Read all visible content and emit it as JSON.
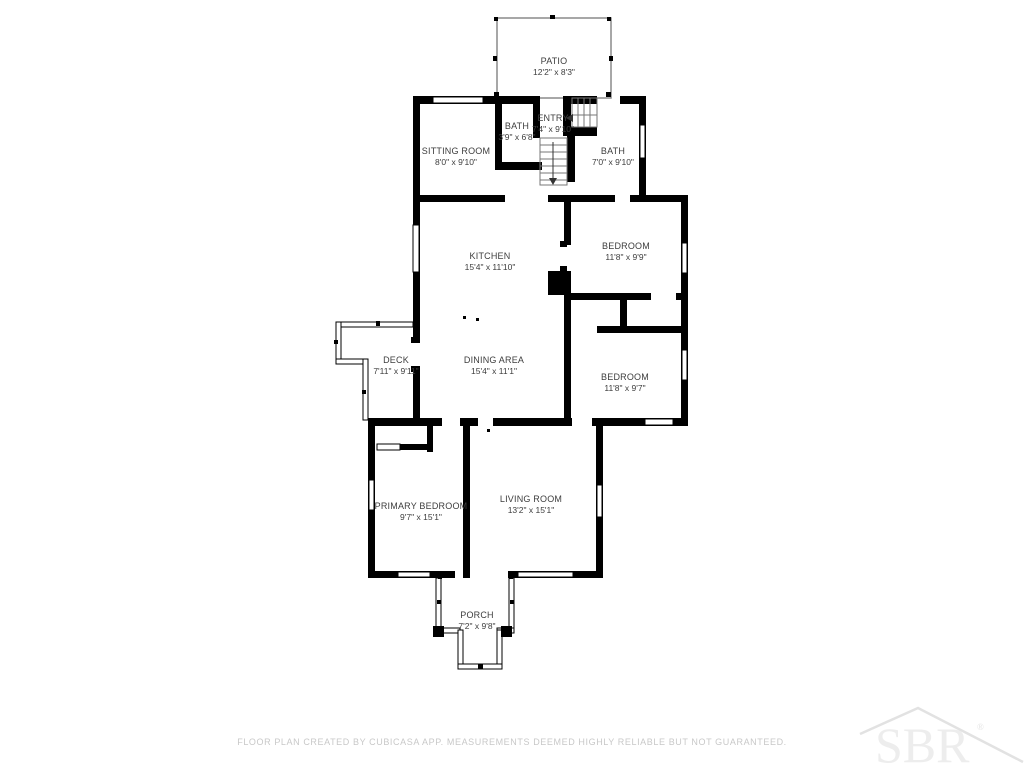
{
  "floorplan": {
    "rooms": [
      {
        "name": "PATIO",
        "dims": "12'2\" x 8'3\""
      },
      {
        "name": "BATH",
        "dims": "3'9\" x 6'8\""
      },
      {
        "name": "ENTRY",
        "dims": "7'4\" x 9'10\""
      },
      {
        "name": "SITTING ROOM",
        "dims": "8'0\" x 9'10\""
      },
      {
        "name": "BATH",
        "dims": "7'0\" x 9'10\""
      },
      {
        "name": "KITCHEN",
        "dims": "15'4\" x 11'10\""
      },
      {
        "name": "BEDROOM",
        "dims": "11'8\" x 9'9\""
      },
      {
        "name": "DECK",
        "dims": "7'11\" x 9'11\""
      },
      {
        "name": "DINING AREA",
        "dims": "15'4\" x 11'1\""
      },
      {
        "name": "BEDROOM",
        "dims": "11'8\" x 9'7\""
      },
      {
        "name": "PRIMARY BEDROOM",
        "dims": "9'7\" x 15'1\""
      },
      {
        "name": "LIVING ROOM",
        "dims": "13'2\" x 15'1\""
      },
      {
        "name": "PORCH",
        "dims": "7'2\" x 9'8\""
      }
    ],
    "footer": "FLOOR PLAN CREATED BY CUBICASA APP. MEASUREMENTS DEEMED HIGHLY RELIABLE BUT NOT GUARANTEED.",
    "watermark": {
      "text": "SBR",
      "mark": "®"
    },
    "colors": {
      "wall": "#000000",
      "label": "#3d3d3d",
      "footer": "#c8c8c8",
      "watermark": "#ededed"
    }
  }
}
